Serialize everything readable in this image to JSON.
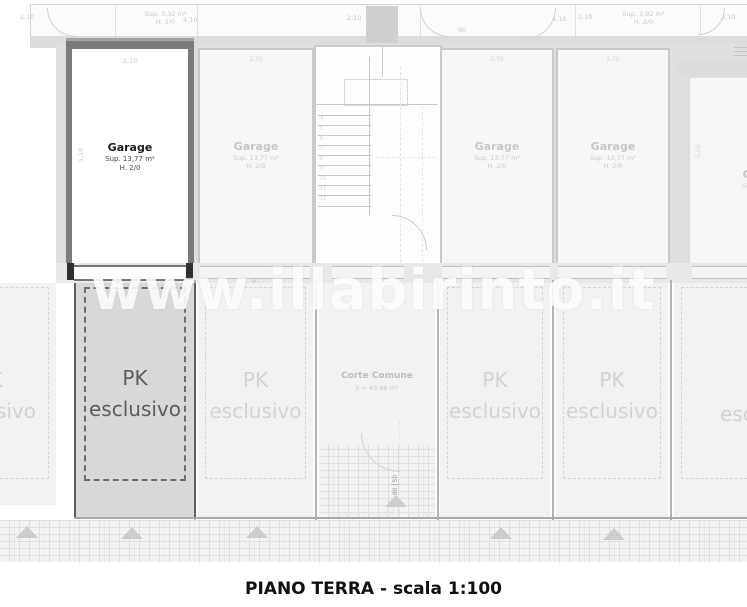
{
  "caption": "PIANO TERRA - scala 1:100",
  "watermark": "www.illabirinto.it",
  "top_strip": {
    "unit_left": {
      "sup": "Sup. 3,32 m²",
      "h": "H. 2/0"
    },
    "unit_right": {
      "sup": "Sup. 3,92 m²",
      "h": "H. 2/0"
    },
    "dims": [
      "2,10",
      "4,10",
      "2,10",
      "90",
      "4,10",
      "2,10",
      "2,10"
    ]
  },
  "garage_highlight": {
    "name": "Garage",
    "sup": "Sup. 13,77 m²",
    "h": "H. 2/0",
    "width_dim": "2,70",
    "depth_dim": "5,10"
  },
  "garages": [
    {
      "name": "Garage",
      "sup": "Sup. 13,77 m²",
      "h": "H. 2/0",
      "width_dim": "2,70"
    },
    {
      "name": "Garage",
      "sup": "Sup. 13,77 m²",
      "h": "H. 2/0",
      "width_dim": "2,70"
    },
    {
      "name": "Garage",
      "sup": "Sup. 13,77 m²",
      "h": "H. 2/0",
      "width_dim": "2,70"
    }
  ],
  "garage_partial": {
    "name": "Garage",
    "sup": "Sup. 13,77 m²",
    "h": "H. 2/0",
    "depth_dim": "5,10"
  },
  "stairs": {
    "steps": [
      "4",
      "5",
      "6",
      "7",
      "8",
      "9",
      "10",
      "11",
      "12"
    ]
  },
  "door_dims": [
    {
      "a": "50",
      "b": "230"
    },
    {
      "a": "250",
      "b": "230"
    },
    {
      "a": "90",
      "b": "30"
    },
    {
      "a": "250",
      "b": "30"
    },
    {
      "a": "50",
      "b": "30"
    }
  ],
  "gate_dim": {
    "a": "80",
    "b": "50"
  },
  "pk": {
    "line1": "PK",
    "line2": "esclusivo"
  },
  "corte": {
    "name": "Corte Comune",
    "area": "S = 63,96 m²"
  }
}
